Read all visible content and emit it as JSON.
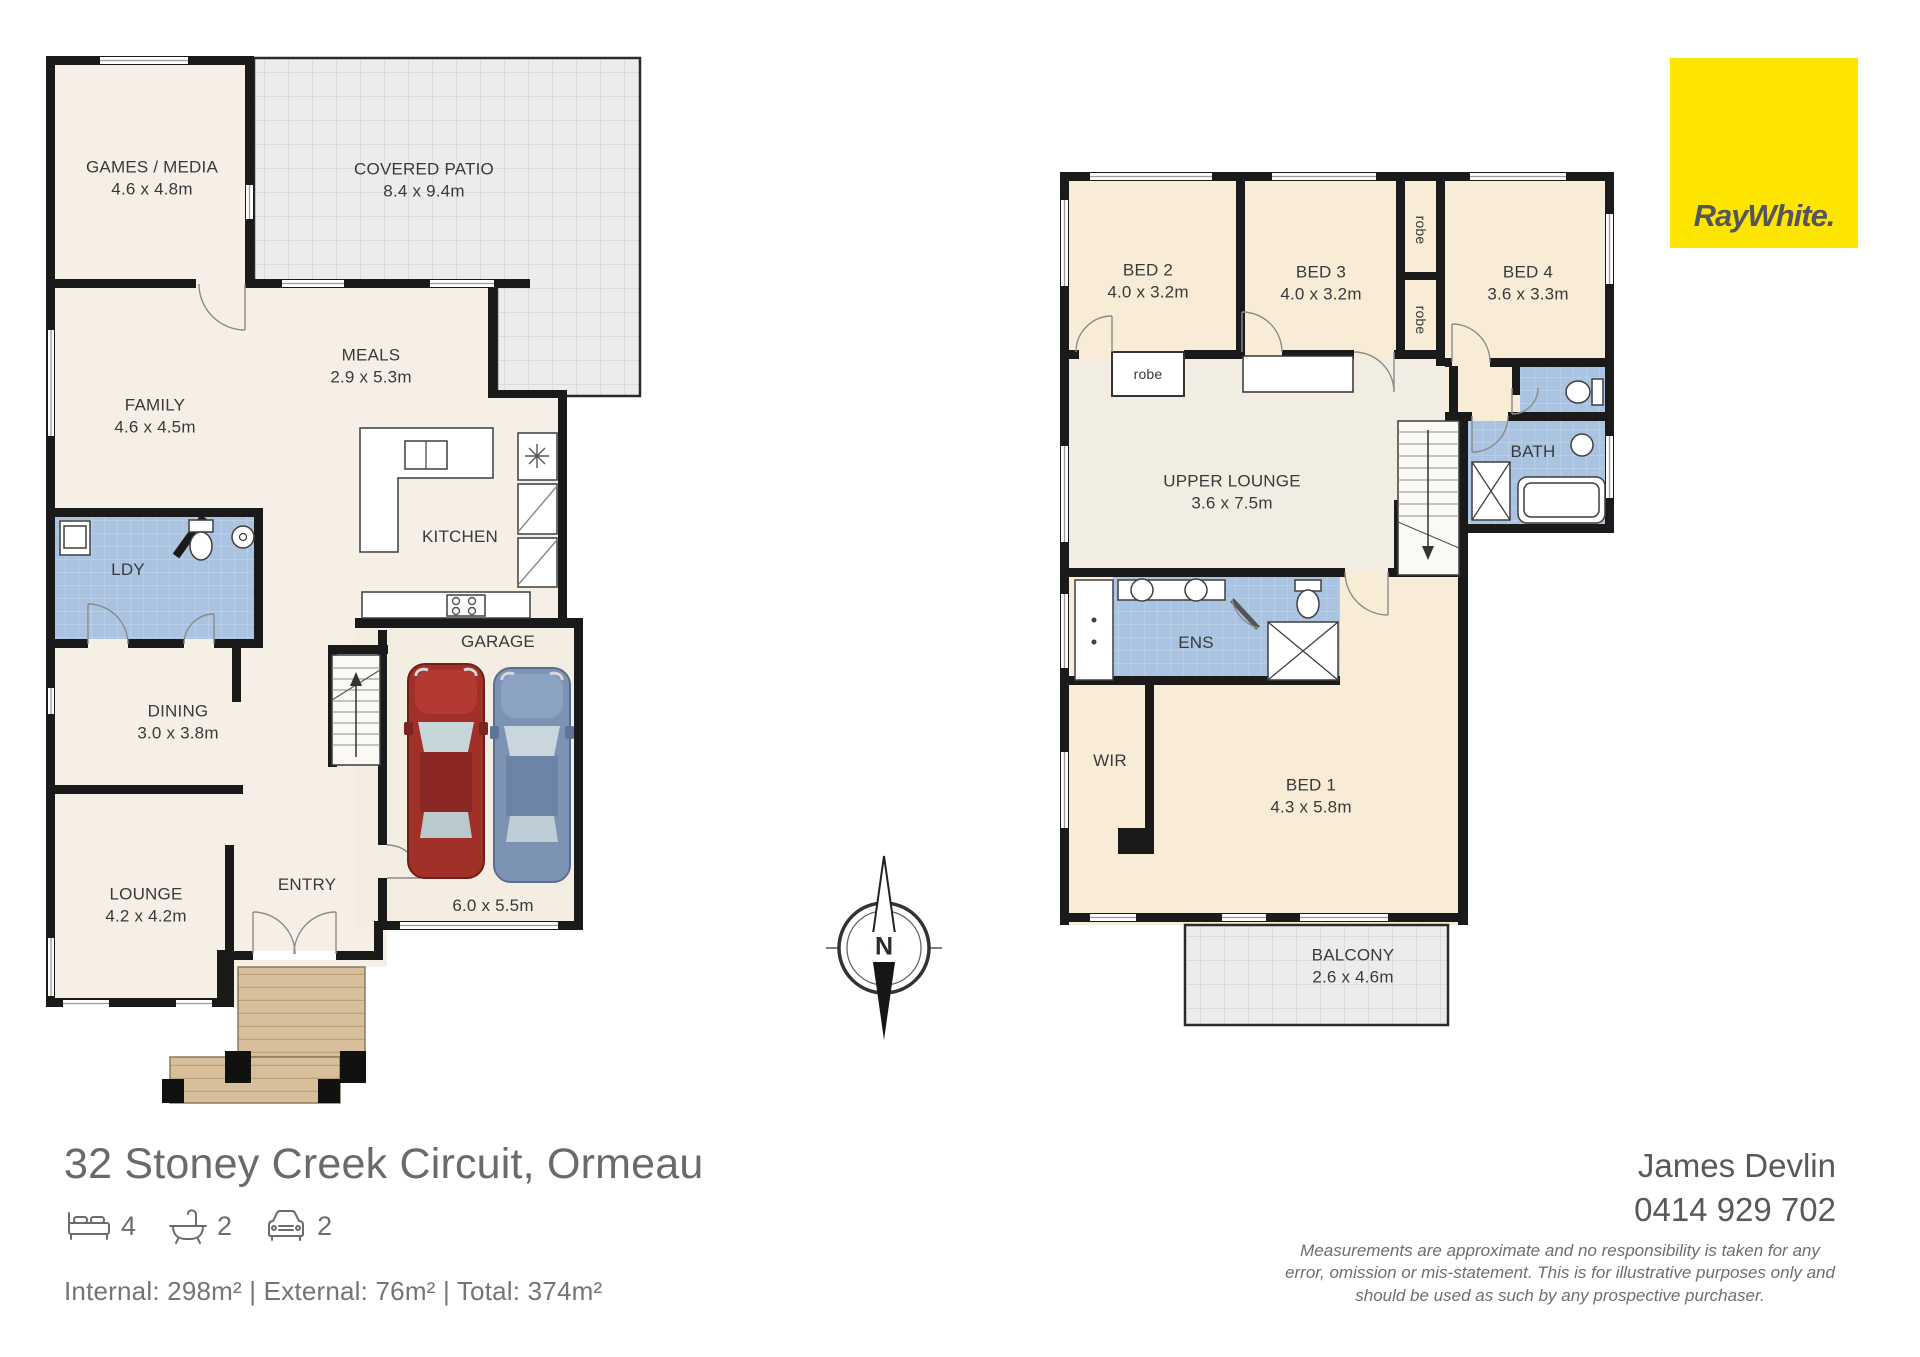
{
  "brand": {
    "logo_text": "RayWhite.",
    "logo_bg": "#fde500",
    "logo_fg": "#54565a"
  },
  "title": {
    "address": "32 Stoney Creek Circuit, Ormeau"
  },
  "stats": {
    "beds": "4",
    "baths": "2",
    "cars": "2"
  },
  "areas": {
    "line": "Internal: 298m² | External: 76m² | Total: 374m²"
  },
  "agent": {
    "name": "James Devlin",
    "phone": "0414 929 702"
  },
  "disclaimer": {
    "line1": "Measurements are approximate and no responsibility is taken for any",
    "line2": "error, omission or mis-statement. This is for illustrative purposes only and",
    "line3": "should be used as such by any prospective purchaser."
  },
  "compass": {
    "north_label": "N"
  },
  "ground_floor": {
    "games_media": {
      "name": "GAMES / MEDIA",
      "dims": "4.6 x 4.8m"
    },
    "covered_patio": {
      "name": "COVERED PATIO",
      "dims": "8.4 x 9.4m"
    },
    "family": {
      "name": "FAMILY",
      "dims": "4.6 x 4.5m"
    },
    "meals": {
      "name": "MEALS",
      "dims": "2.9 x 5.3m"
    },
    "kitchen": {
      "name": "KITCHEN"
    },
    "laundry": {
      "name": "LDY"
    },
    "dining": {
      "name": "DINING",
      "dims": "3.0 x 3.8m"
    },
    "lounge": {
      "name": "LOUNGE",
      "dims": "4.2 x 4.2m"
    },
    "entry": {
      "name": "ENTRY"
    },
    "garage": {
      "name": "GARAGE",
      "dims": "6.0 x 5.5m"
    }
  },
  "upper_floor": {
    "bed2": {
      "name": "BED 2",
      "dims": "4.0 x 3.2m"
    },
    "bed3": {
      "name": "BED 3",
      "dims": "4.0 x 3.2m"
    },
    "bed4": {
      "name": "BED 4",
      "dims": "3.6 x 3.3m"
    },
    "robe_bed2": {
      "name": "robe"
    },
    "robe_upper": {
      "name": "robe"
    },
    "robe_lower": {
      "name": "robe"
    },
    "upper_lounge": {
      "name": "UPPER LOUNGE",
      "dims": "3.6 x 7.5m"
    },
    "bath": {
      "name": "BATH"
    },
    "ens": {
      "name": "ENS"
    },
    "wir": {
      "name": "WIR"
    },
    "bed1": {
      "name": "BED 1",
      "dims": "4.3 x 5.8m"
    },
    "balcony": {
      "name": "BALCONY",
      "dims": "2.6 x 4.6m"
    }
  }
}
